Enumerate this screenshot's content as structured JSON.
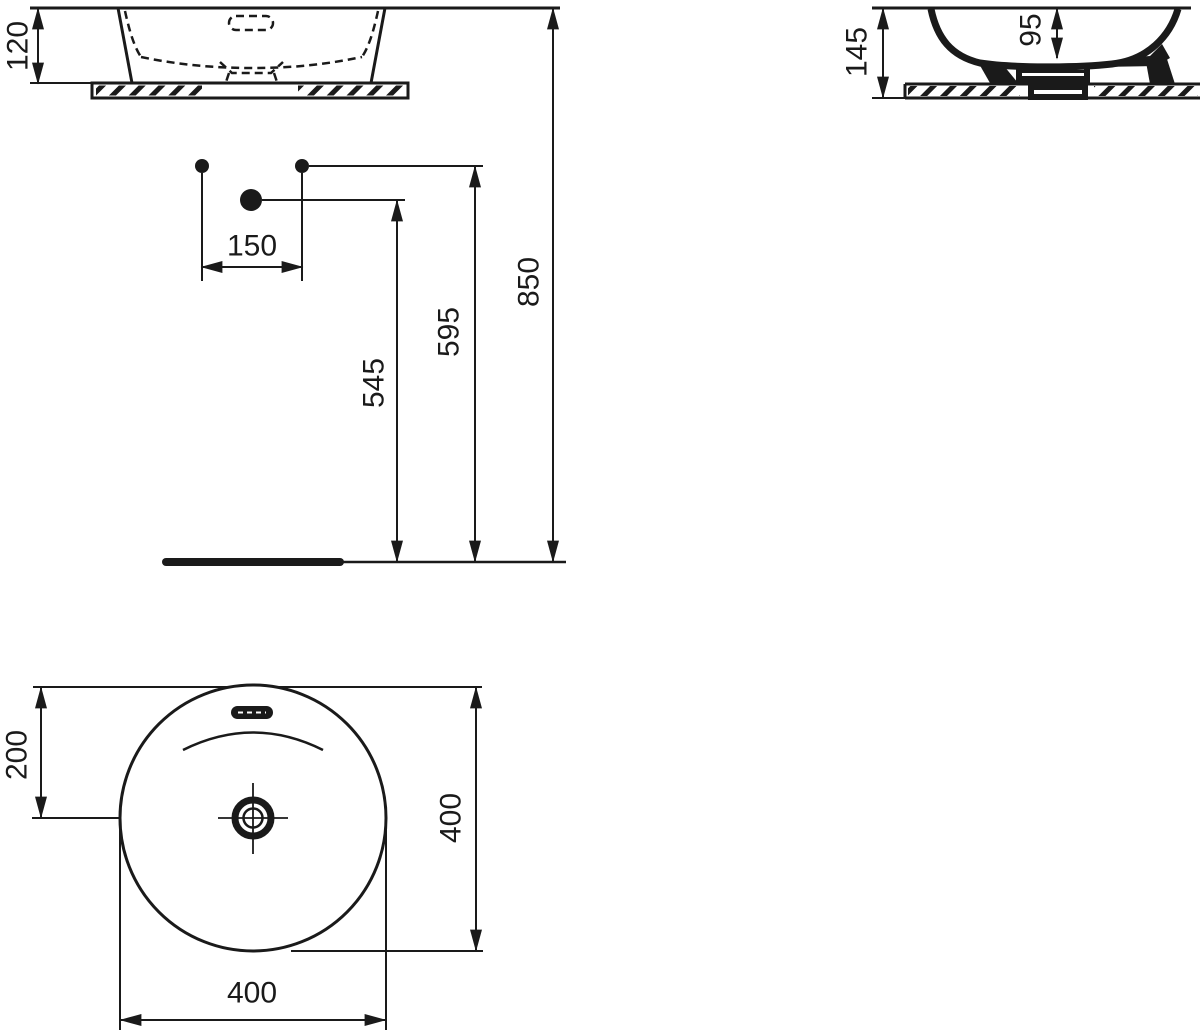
{
  "colors": {
    "ink": "#1a1a1a",
    "paper": "#ffffff"
  },
  "views": {
    "front_elevation": {
      "dims": {
        "basin_height": "120"
      }
    },
    "side_section": {
      "dims": {
        "overall_height": "145",
        "bowl_depth": "95"
      }
    },
    "installation": {
      "dims": {
        "tap_hole_spacing": "150",
        "waste_outlet_height": "545",
        "tap_hole_height": "595",
        "rim_height": "850"
      }
    },
    "plan": {
      "dims": {
        "overflow_to_centre": "200",
        "depth": "400",
        "width": "400"
      }
    }
  }
}
